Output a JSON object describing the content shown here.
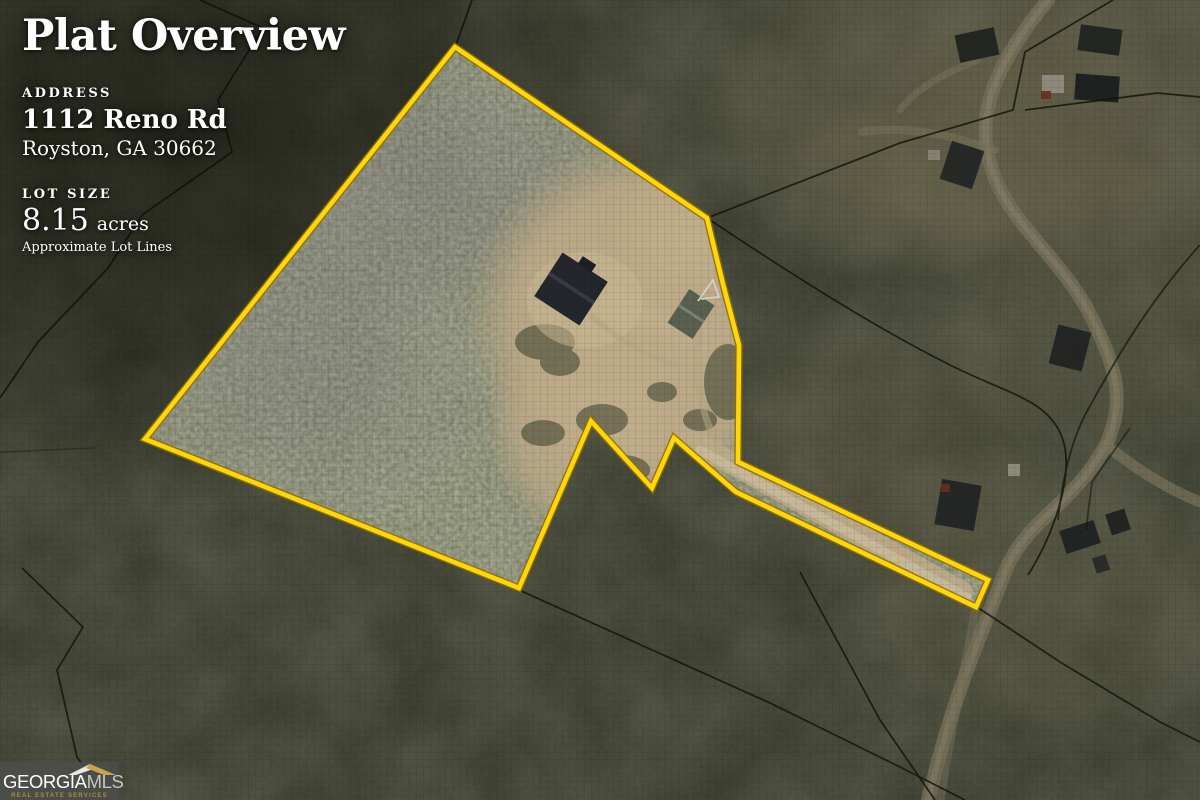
{
  "header": {
    "title": "Plat Overview"
  },
  "property": {
    "address_label": "ADDRESS",
    "address_line1": "1112 Reno Rd",
    "address_line2": "Royston, GA 30662",
    "lot_size_label": "LOT SIZE",
    "lot_size_value": "8.15",
    "lot_size_unit": "acres",
    "lot_size_note": "Approximate Lot Lines"
  },
  "branding": {
    "brand_primary": "GEORGIA",
    "brand_secondary": "MLS",
    "tagline": "REAL ESTATE SERVICES"
  },
  "map": {
    "type": "aerial-plat",
    "boundary_color": "#ffd60a",
    "boundary_outline_color": "#8f6f05",
    "boundary_points": "455,47 707,218 723,284 739,345 738,462 988,580 976,607 736,492 674,438 652,488 591,421 519,588 145,439"
  }
}
